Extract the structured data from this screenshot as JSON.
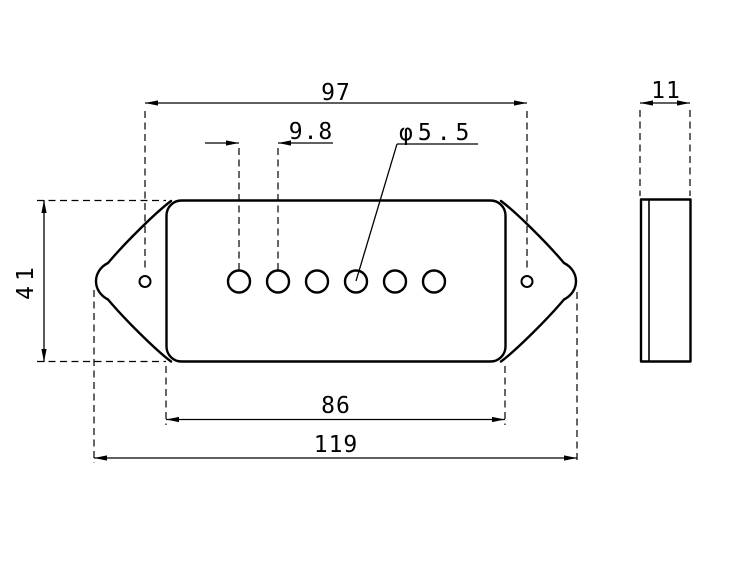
{
  "drawing": {
    "background_color": "#ffffff",
    "line_color": "#000000",
    "front_view": {
      "dim_mount_hole_spacing": "97",
      "dim_pole_spacing": "9.8",
      "dim_pole_hole_diameter": "φ5.5",
      "dim_height": "41",
      "dim_body_width": "86",
      "dim_overall_width": "119",
      "pole_hole_count": 6,
      "mount_hole_count": 2
    },
    "side_view": {
      "dim_thickness": "11"
    }
  }
}
